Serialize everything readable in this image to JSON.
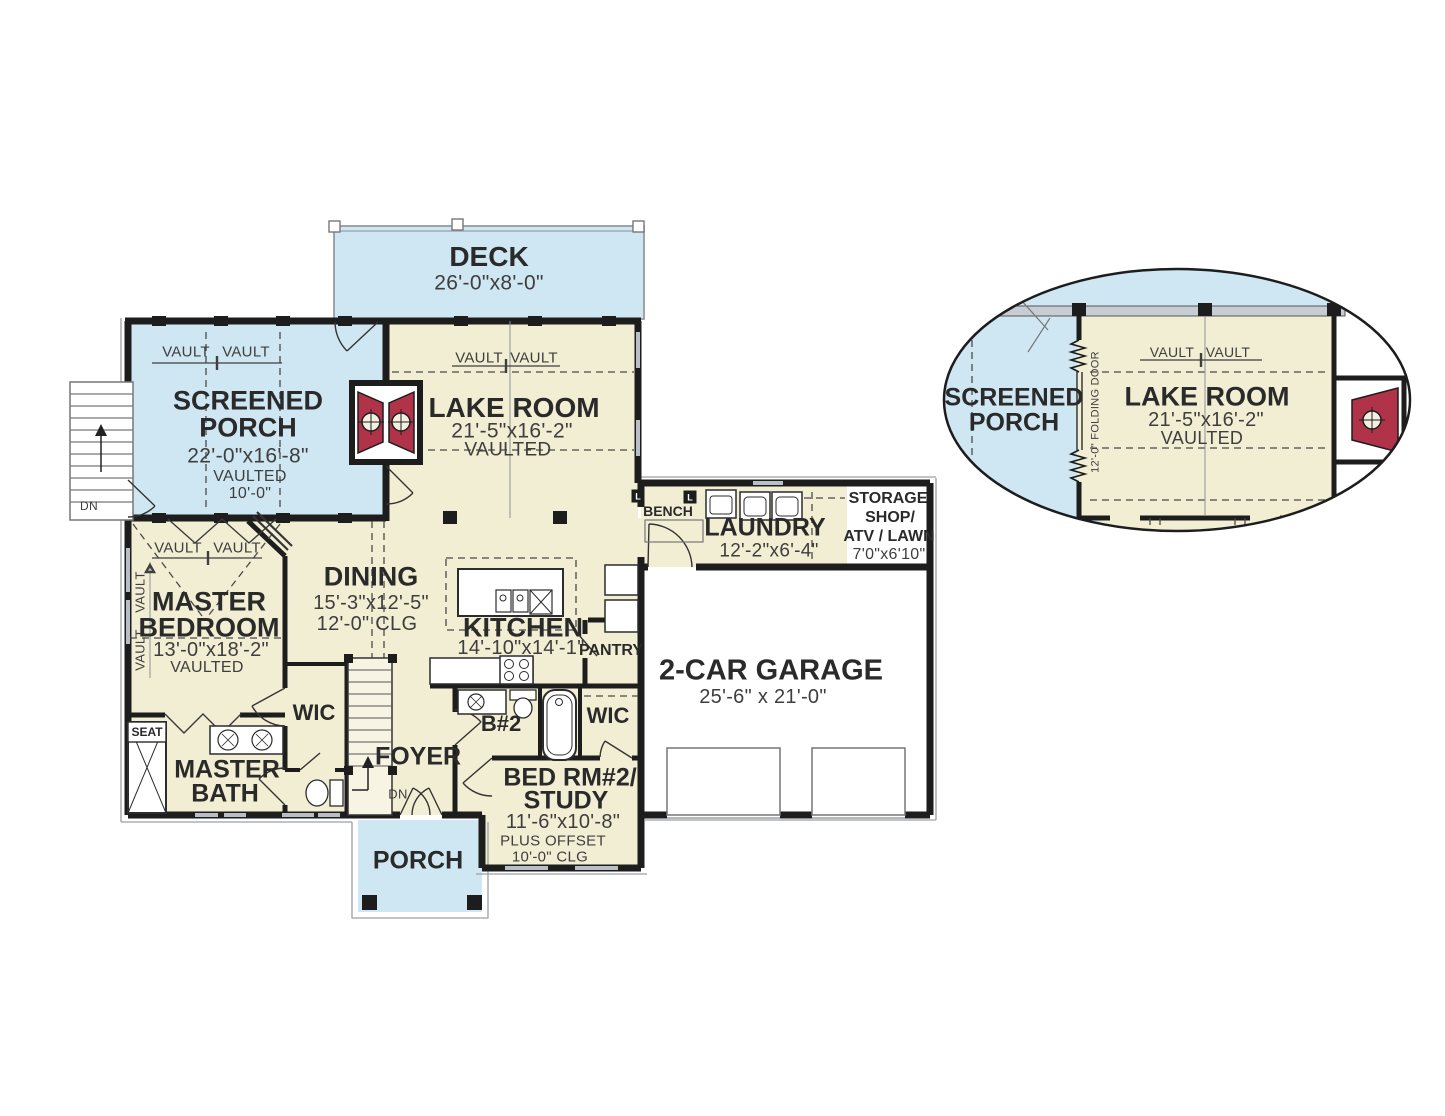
{
  "colors": {
    "room_fill": "#f2eed3",
    "outdoor_fill": "#cfe7f2",
    "wall": "#1d1d1d",
    "fireplace_red": "#b03349",
    "window_gray": "#b9bfc6",
    "label_text": "#2a2a2a",
    "dim_text": "#3e3e3e"
  },
  "labels": {
    "deck": {
      "name": "DECK",
      "dims": "26'-0\"x8'-0\""
    },
    "screened_porch": {
      "name_line1": "SCREENED",
      "name_line2": "PORCH",
      "dims": "22'-0\"x16'-8\"",
      "vaulted": "VAULTED",
      "height": "10'-0\""
    },
    "lake_room": {
      "name": "LAKE ROOM",
      "dims": "21'-5\"x16'-2\"",
      "vaulted": "VAULTED"
    },
    "master_bedroom": {
      "name_line1": "MASTER",
      "name_line2": "BEDROOM",
      "dims": "13'-0\"x18'-2\"",
      "vaulted": "VAULTED"
    },
    "dining": {
      "name": "DINING",
      "dims": "15'-3\"x12'-5\"",
      "ceiling": "12'-0\" CLG"
    },
    "kitchen": {
      "name": "KITCHEN",
      "dims": "14'-10\"x14'-1\""
    },
    "pantry": {
      "name": "PANTRY"
    },
    "laundry": {
      "name": "LAUNDRY",
      "dims": "12'-2\"x6'-4\"",
      "bench": "BENCH"
    },
    "storage": {
      "line1": "STORAGE",
      "line2": "SHOP/",
      "line3": "ATV / LAWN",
      "dims": "7'0\"x6'10\""
    },
    "garage": {
      "name": "2-CAR GARAGE",
      "dims": "25'-6\" x 21'-0\""
    },
    "master_bath": {
      "name_line1": "MASTER",
      "name_line2": "BATH",
      "seat": "SEAT"
    },
    "wic_master": {
      "name": "WIC"
    },
    "wic_bed2": {
      "name": "WIC"
    },
    "bath2": {
      "name": "B#2"
    },
    "foyer": {
      "name": "FOYER",
      "down": "DN"
    },
    "bed2": {
      "name_line1": "BED RM#2/",
      "name_line2": "STUDY",
      "dims": "11'-6\"x10'-8\"",
      "offset": "PLUS OFFSET",
      "ceiling": "10'-0\" CLG"
    },
    "porch": {
      "name": "PORCH"
    },
    "exterior_stairs": {
      "down": "DN"
    },
    "vault": "VAULT",
    "jamb": "L"
  },
  "inset": {
    "screened_porch_line1": "SCREENED",
    "screened_porch_line2": "PORCH",
    "lake_room": "LAKE ROOM",
    "dims": "21'-5\"x16'-2\"",
    "vaulted": "VAULTED",
    "vault": "VAULT",
    "folding_door": "12'-0\" FOLDING DOOR"
  }
}
